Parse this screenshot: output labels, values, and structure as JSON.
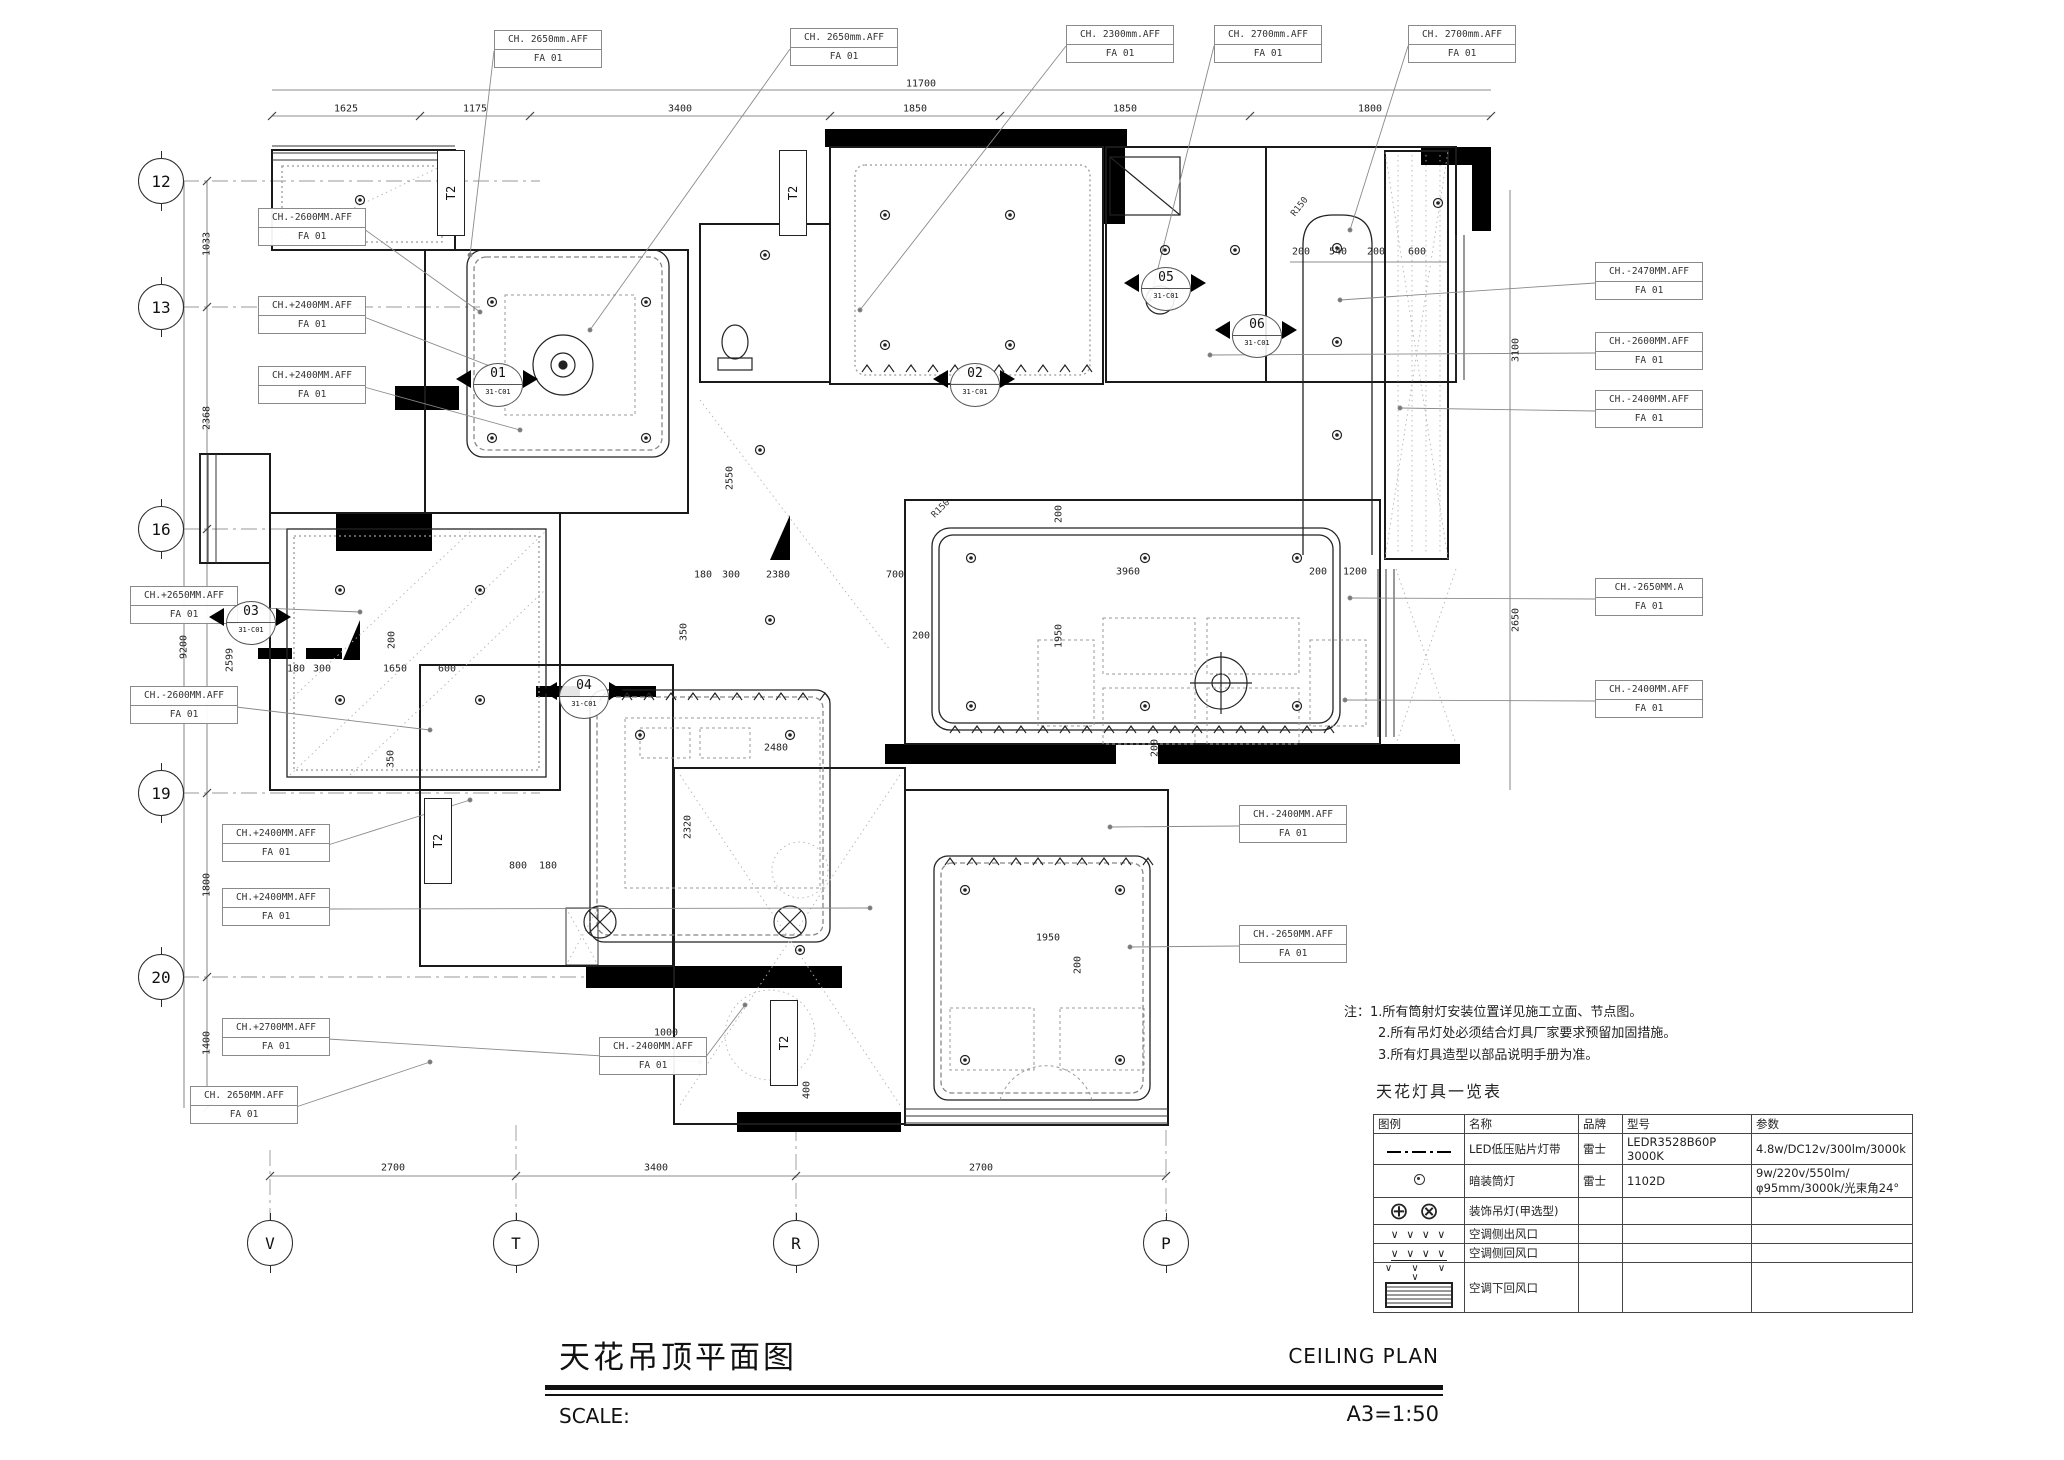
{
  "title_block": {
    "title_cn": "天花吊顶平面图",
    "title_en": "CEILING PLAN",
    "scale_label": "SCALE:",
    "scale_value": "A3=1:50"
  },
  "notes": {
    "prefix": "注：",
    "items": [
      "1.所有筒射灯安装位置详见施工立面、节点图。",
      "2.所有吊灯处必须结合灯具厂家要求预留加固措施。",
      "3.所有灯具造型以部品说明手册为准。"
    ]
  },
  "legend": {
    "title": "天花灯具一览表",
    "headers": [
      "图例",
      "名称",
      "品牌",
      "型号",
      "参数"
    ],
    "rows": [
      {
        "symbol": "led-strip",
        "name": "LED低压贴片灯带",
        "brand": "雷士",
        "model": "LEDR3528B60P 3000K",
        "params": "4.8w/DC12v/300lm/3000k"
      },
      {
        "symbol": "downlight",
        "name": "暗装筒灯",
        "brand": "雷士",
        "model": "1102D",
        "params": "9w/220v/550lm/φ95mm/3000k/光束角24°"
      },
      {
        "symbol": "pendant",
        "name": "装饰吊灯(甲选型)",
        "brand": "",
        "model": "",
        "params": ""
      },
      {
        "symbol": "ac-side-supply",
        "name": "空调侧出风口",
        "brand": "",
        "model": "",
        "params": ""
      },
      {
        "symbol": "ac-side-return",
        "name": "空调侧回风口",
        "brand": "",
        "model": "",
        "params": ""
      },
      {
        "symbol": "ac-bottom-return",
        "name": "空调下回风口",
        "brand": "",
        "model": "",
        "params": ""
      }
    ],
    "pendant_glyphs": "⊕⊗",
    "arrow_glyphs": "∨ ∨ ∨ ∨"
  },
  "grid": {
    "left": [
      {
        "label": "12",
        "x": 161,
        "y": 181
      },
      {
        "label": "13",
        "x": 161,
        "y": 307
      },
      {
        "label": "16",
        "x": 161,
        "y": 529
      },
      {
        "label": "19",
        "x": 161,
        "y": 793
      },
      {
        "label": "20",
        "x": 161,
        "y": 977
      }
    ],
    "bottom": [
      {
        "label": "V",
        "x": 270,
        "y": 1243
      },
      {
        "label": "T",
        "x": 516,
        "y": 1243
      },
      {
        "label": "R",
        "x": 796,
        "y": 1243
      },
      {
        "label": "P",
        "x": 1166,
        "y": 1243
      }
    ]
  },
  "finish_code": "FA 01",
  "ch_labels": [
    {
      "text": "CH. 2650mm.AFF",
      "x": 494,
      "y": 30,
      "lx": 470,
      "ly": 255
    },
    {
      "text": "CH. 2650mm.AFF",
      "x": 790,
      "y": 28,
      "lx": 590,
      "ly": 330
    },
    {
      "text": "CH. 2300mm.AFF",
      "x": 1066,
      "y": 25,
      "lx": 860,
      "ly": 310
    },
    {
      "text": "CH. 2700mm.AFF",
      "x": 1214,
      "y": 25,
      "lx": 1150,
      "ly": 300
    },
    {
      "text": "CH. 2700mm.AFF",
      "x": 1408,
      "y": 25,
      "lx": 1350,
      "ly": 230
    },
    {
      "text": "CH.-2600MM.AFF",
      "x": 258,
      "y": 208,
      "lx": 480,
      "ly": 312
    },
    {
      "text": "CH.+2400MM.AFF",
      "x": 258,
      "y": 296,
      "lx": 500,
      "ly": 370
    },
    {
      "text": "CH.+2400MM.AFF",
      "x": 258,
      "y": 366,
      "lx": 520,
      "ly": 430
    },
    {
      "text": "CH.+2650MM.AFF",
      "x": 130,
      "y": 586,
      "lx": 360,
      "ly": 612
    },
    {
      "text": "CH.-2600MM.AFF",
      "x": 130,
      "y": 686,
      "lx": 430,
      "ly": 730
    },
    {
      "text": "CH.+2400MM.AFF",
      "x": 222,
      "y": 824,
      "lx": 470,
      "ly": 800
    },
    {
      "text": "CH.+2400MM.AFF",
      "x": 222,
      "y": 888,
      "lx": 870,
      "ly": 908
    },
    {
      "text": "CH.+2700MM.AFF",
      "x": 222,
      "y": 1018,
      "lx": 700,
      "ly": 1062
    },
    {
      "text": "CH. 2650MM.AFF",
      "x": 190,
      "y": 1086,
      "lx": 430,
      "ly": 1062
    },
    {
      "text": "CH.-2400MM.AFF",
      "x": 599,
      "y": 1037,
      "lx": 745,
      "ly": 1005
    },
    {
      "text": "CH.-2400MM.AFF",
      "x": 1239,
      "y": 805,
      "lx": 1110,
      "ly": 827
    },
    {
      "text": "CH.-2650MM.AFF",
      "x": 1239,
      "y": 925,
      "lx": 1130,
      "ly": 947
    },
    {
      "text": "CH.-2470MM.AFF",
      "x": 1595,
      "y": 262,
      "lx": 1340,
      "ly": 300
    },
    {
      "text": "CH.-2600MM.AFF",
      "x": 1595,
      "y": 332,
      "lx": 1210,
      "ly": 355
    },
    {
      "text": "CH.-2400MM.AFF",
      "x": 1595,
      "y": 390,
      "lx": 1400,
      "ly": 408
    },
    {
      "text": "CH.-2650MM.A",
      "x": 1595,
      "y": 578,
      "lx": 1350,
      "ly": 598
    },
    {
      "text": "CH.-2400MM.AFF",
      "x": 1595,
      "y": 680,
      "lx": 1345,
      "ly": 700
    }
  ],
  "section_markers": [
    {
      "num": "01",
      "sub": "31-C01",
      "x": 497,
      "y": 379
    },
    {
      "num": "02",
      "sub": "31-C01",
      "x": 974,
      "y": 379
    },
    {
      "num": "03",
      "sub": "31-C01",
      "x": 250,
      "y": 617
    },
    {
      "num": "04",
      "sub": "31-C01",
      "x": 583,
      "y": 691
    },
    {
      "num": "05",
      "sub": "31-C01",
      "x": 1165,
      "y": 283
    },
    {
      "num": "06",
      "sub": "31-C01",
      "x": 1256,
      "y": 330
    }
  ],
  "shaft_label": "T2",
  "shafts": [
    {
      "x": 437,
      "y": 150
    },
    {
      "x": 779,
      "y": 150
    },
    {
      "x": 424,
      "y": 798
    },
    {
      "x": 770,
      "y": 1000
    }
  ],
  "radius_labels": [
    {
      "t": "R150",
      "x": 941,
      "y": 509,
      "r": -45
    },
    {
      "t": "R150",
      "x": 1300,
      "y": 207,
      "r": -52
    }
  ],
  "dims": [
    [
      "11700",
      921,
      84,
      0
    ],
    [
      "1625",
      346,
      109,
      0
    ],
    [
      "1175",
      475,
      109,
      0
    ],
    [
      "3400",
      680,
      109,
      0
    ],
    [
      "1850",
      915,
      109,
      0
    ],
    [
      "1850",
      1125,
      109,
      0
    ],
    [
      "1800",
      1370,
      109,
      0
    ],
    [
      "200",
      1301,
      252,
      0
    ],
    [
      "540",
      1338,
      252,
      0
    ],
    [
      "200",
      1376,
      252,
      0
    ],
    [
      "600",
      1417,
      252,
      0
    ],
    [
      "3100",
      1516,
      350,
      -90
    ],
    [
      "2650",
      1516,
      620,
      -90
    ],
    [
      "1033",
      207,
      244,
      -90
    ],
    [
      "2368",
      207,
      418,
      -90
    ],
    [
      "9200",
      184,
      647,
      -90
    ],
    [
      "2599",
      230,
      660,
      -90
    ],
    [
      "1800",
      207,
      885,
      -90
    ],
    [
      "1400",
      207,
      1043,
      -90
    ],
    [
      "2700",
      393,
      1168,
      0
    ],
    [
      "3400",
      656,
      1168,
      0
    ],
    [
      "2700",
      981,
      1168,
      0
    ],
    [
      "2550",
      730,
      478,
      -90
    ],
    [
      "180",
      703,
      575,
      0
    ],
    [
      "300",
      731,
      575,
      0
    ],
    [
      "2380",
      778,
      575,
      0
    ],
    [
      "700",
      895,
      575,
      0
    ],
    [
      "350",
      684,
      632,
      -90
    ],
    [
      "180",
      296,
      669,
      0
    ],
    [
      "300",
      322,
      669,
      0
    ],
    [
      "1650",
      395,
      669,
      0
    ],
    [
      "600",
      447,
      669,
      0
    ],
    [
      "200",
      392,
      640,
      -90
    ],
    [
      "350",
      391,
      759,
      -90
    ],
    [
      "3960",
      1128,
      572,
      0
    ],
    [
      "1950",
      1059,
      636,
      -90
    ],
    [
      "200",
      921,
      636,
      0
    ],
    [
      "200",
      1059,
      514,
      -90
    ],
    [
      "200",
      1318,
      572,
      0
    ],
    [
      "1200",
      1355,
      572,
      0
    ],
    [
      "200",
      1155,
      748,
      -90
    ],
    [
      "2480",
      776,
      748,
      0
    ],
    [
      "2320",
      688,
      827,
      -90
    ],
    [
      "800",
      518,
      866,
      0
    ],
    [
      "180",
      548,
      866,
      0
    ],
    [
      "1000",
      666,
      1033,
      0
    ],
    [
      "400",
      807,
      1090,
      -90
    ],
    [
      "1950",
      1048,
      938,
      0
    ],
    [
      "200",
      1078,
      965,
      -90
    ]
  ]
}
